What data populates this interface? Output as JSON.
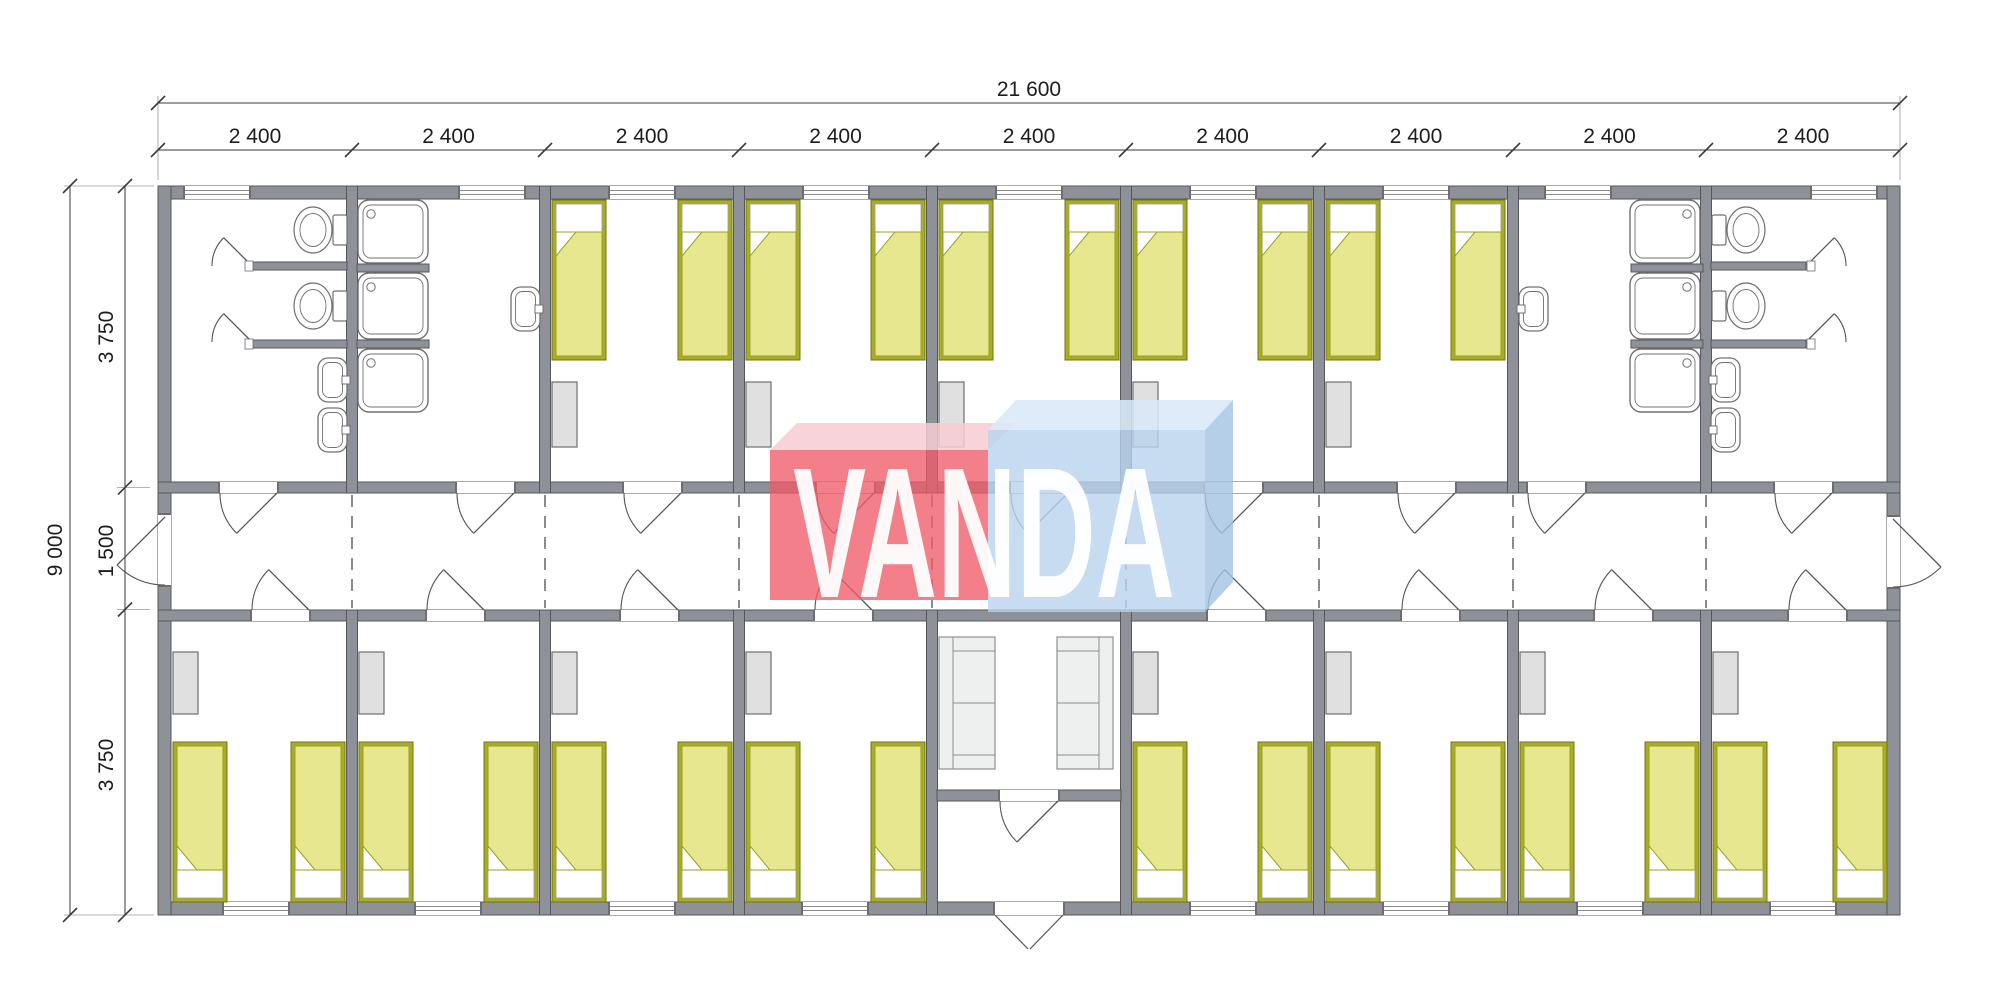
{
  "watermark": {
    "text": "VANDA",
    "red_front": "#ee5b69",
    "red_top": "#f7ccd3",
    "blue_front": "#b9d3ee",
    "blue_top": "#d9e9f8",
    "blue_side": "#a3c3e2",
    "text_color": "#ffffff"
  },
  "dimensions": {
    "top_total": "21 600",
    "top_segments": [
      "2 400",
      "2 400",
      "2 400",
      "2 400",
      "2 400",
      "2 400",
      "2 400",
      "2 400",
      "2 400"
    ],
    "left_total": "9 000",
    "left_segments": [
      "3 750",
      "1 500",
      "3 750"
    ]
  },
  "colors": {
    "wall": "#8e9197",
    "wall_stroke": "#54565a",
    "jamb": "#6b6d72",
    "bed_frame": "#a9ac26",
    "bed_frame_stroke": "#72760f",
    "bed_blanket": "#e6e78e",
    "bed_blanket_stroke": "#9aa01e",
    "furniture": "#e0e0e0",
    "furniture_stroke": "#6e6e6e",
    "sofa": "#eef0f0",
    "sofa_stroke": "#8f8f8f",
    "fixture_stroke": "#707070",
    "door_line": "#555555",
    "dash_line": "#5a5a5a",
    "dim_line": "#3a3a3a",
    "dim_text": "#1c1c1c",
    "window_line": "#8a8a8a"
  },
  "floor_plan": {
    "building": {
      "modules": 9,
      "module_width_label": "2 400",
      "total_width_label": "21 600",
      "total_depth_label": "9 000"
    },
    "corridor": {
      "position": "center",
      "end_doors": [
        "west-exit",
        "east-exit"
      ],
      "module_joint_lines": 8
    },
    "top_row": [
      {
        "room": "sanitary-wc-left",
        "fixtures": {
          "toilets": 2,
          "washbasins": 2,
          "stall_doors": 2
        },
        "window": true,
        "corridor_door": true
      },
      {
        "room": "sanitary-shower-left",
        "fixtures": {
          "showers": 3,
          "washbasins": 1
        },
        "window": true,
        "corridor_door": true
      },
      {
        "room": "bedroom-top-1",
        "fixtures": {
          "beds": 2,
          "wardrobes": 1
        },
        "window": true,
        "corridor_door": true
      },
      {
        "room": "bedroom-top-2",
        "fixtures": {
          "beds": 2,
          "wardrobes": 1
        },
        "window": true,
        "corridor_door": true
      },
      {
        "room": "bedroom-top-3",
        "fixtures": {
          "beds": 2,
          "wardrobes": 1
        },
        "window": true,
        "corridor_door": true
      },
      {
        "room": "bedroom-top-4",
        "fixtures": {
          "beds": 2,
          "wardrobes": 1
        },
        "window": true,
        "corridor_door": true
      },
      {
        "room": "bedroom-top-5",
        "fixtures": {
          "beds": 2,
          "wardrobes": 1
        },
        "window": true,
        "corridor_door": true
      },
      {
        "room": "sanitary-shower-right",
        "fixtures": {
          "showers": 3,
          "washbasins": 1
        },
        "window": true,
        "corridor_door": true
      },
      {
        "room": "sanitary-wc-right",
        "fixtures": {
          "toilets": 2,
          "washbasins": 2,
          "stall_doors": 2
        },
        "window": true,
        "corridor_door": true
      }
    ],
    "bottom_row": [
      {
        "room": "bedroom-bottom-1",
        "fixtures": {
          "beds": 2,
          "wardrobes": 1
        },
        "window": true,
        "corridor_door": true
      },
      {
        "room": "bedroom-bottom-2",
        "fixtures": {
          "beds": 2,
          "wardrobes": 1
        },
        "window": true,
        "corridor_door": true
      },
      {
        "room": "bedroom-bottom-3",
        "fixtures": {
          "beds": 2,
          "wardrobes": 1
        },
        "window": true,
        "corridor_door": true
      },
      {
        "room": "bedroom-bottom-4",
        "fixtures": {
          "beds": 2,
          "wardrobes": 1
        },
        "window": true,
        "corridor_door": true
      },
      {
        "room": "entrance-lobby",
        "fixtures": {
          "sofas": 2
        },
        "doors": {
          "entrance_double": true,
          "vestibule_door": true,
          "open_to_corridor": true
        }
      },
      {
        "room": "bedroom-bottom-5",
        "fixtures": {
          "beds": 2,
          "wardrobes": 1
        },
        "window": true,
        "corridor_door": true
      },
      {
        "room": "bedroom-bottom-6",
        "fixtures": {
          "beds": 2,
          "wardrobes": 1
        },
        "window": true,
        "corridor_door": true
      },
      {
        "room": "bedroom-bottom-7",
        "fixtures": {
          "beds": 2,
          "wardrobes": 1
        },
        "window": true,
        "corridor_door": true
      },
      {
        "room": "bedroom-bottom-8",
        "fixtures": {
          "beds": 2,
          "wardrobes": 1
        },
        "window": true,
        "corridor_door": true
      }
    ]
  }
}
